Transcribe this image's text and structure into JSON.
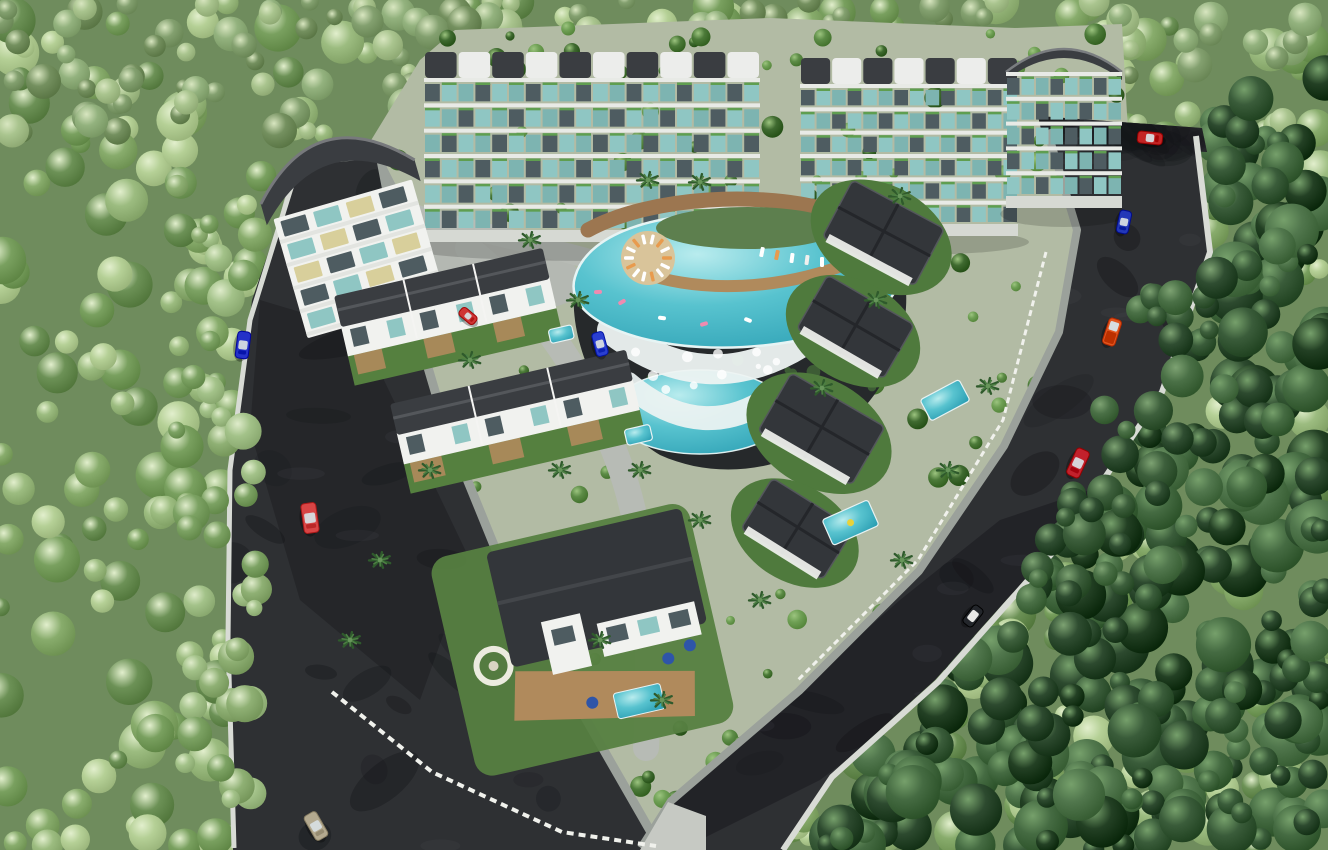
{
  "meta": {
    "width": 1328,
    "height": 850
  },
  "palette": {
    "forest_base": "#6f8c5d",
    "site": "#b2bba4",
    "asphalt": "#2e3033",
    "curb": "#d8dbd5",
    "pavement_parking": "#9ba19b",
    "pavement_plaza": "#b4b8b2",
    "pavement_median": "#c6c9c3",
    "internal_road": "#b7bbb5",
    "pool_deep": "#2da0b4",
    "pool_mid": "#58c3cf",
    "pool_light": "#b9ecee",
    "wood": "#9c7650",
    "wood_light": "#b08a5c",
    "roof_dark": "#3a3d41",
    "roof_villa": "#33363a",
    "facade_white": "#f1f2ef",
    "slab_white": "#e8eae6",
    "glass_teal": "#8fc6c3",
    "glass_dark": "#4e5c61",
    "glass_lit": "#d8cf9b",
    "planter_green": "#5f9e50",
    "garden_green": "#55803f",
    "deck_tan": "#b08a5c",
    "foam_white": "#edf3f2",
    "cliff_dark": "#26292b",
    "fence_white": "#f0f1ec",
    "windshield": "#d7dde0"
  },
  "forest": {
    "zones": [
      {
        "name": "sunlit-forest",
        "layer": "under",
        "rect": [
          0,
          0,
          1328,
          850
        ],
        "count": 520,
        "palette": [
          "#9cbc80",
          "#88ac6c",
          "#79a05f",
          "#b5d096",
          "#6c9156"
        ],
        "highlight": "#e2efcd",
        "rMin": 9,
        "rMax": 24,
        "seed": 7
      },
      {
        "name": "top-band-forest",
        "layer": "under",
        "rect": [
          0,
          0,
          1328,
          140
        ],
        "count": 170,
        "palette": [
          "#83a06f",
          "#93b27e",
          "#74905f",
          "#a9c48e"
        ],
        "highlight": "#d8e6c0",
        "rMin": 8,
        "rMax": 18,
        "seed": 11
      },
      {
        "name": "dark-right-forest",
        "layer": "under",
        "polygon": [
          [
            1205,
            118
          ],
          [
            1328,
            60
          ],
          [
            1328,
            850
          ],
          [
            800,
            850
          ],
          [
            845,
            780
          ],
          [
            950,
            672
          ],
          [
            1072,
            540
          ],
          [
            1172,
            392
          ],
          [
            1218,
            248
          ]
        ],
        "count": 300,
        "palette": [
          "#2d4a2f",
          "#3a5c3a",
          "#234024",
          "#456b42",
          "#51774d"
        ],
        "highlight": "#76a06b",
        "rMin": 10,
        "rMax": 28,
        "seed": 23
      },
      {
        "name": "left-overhang-trees",
        "layer": "over",
        "rect": [
          176,
          170,
          84,
          640
        ],
        "count": 46,
        "palette": [
          "#8fb074",
          "#7ca263",
          "#a3c289"
        ],
        "highlight": "#dfeccb",
        "rMin": 8,
        "rMax": 20,
        "seed": 31
      },
      {
        "name": "right-overhang-trees",
        "layer": "over",
        "polygon": [
          [
            1150,
            260
          ],
          [
            1245,
            260
          ],
          [
            1100,
            650
          ],
          [
            1005,
            650
          ]
        ],
        "count": 38,
        "palette": [
          "#2f4d31",
          "#3d5f3c",
          "#4a7046"
        ],
        "highlight": "#7da272",
        "rMin": 9,
        "rMax": 22,
        "seed": 41
      }
    ]
  },
  "site": {
    "platform": [
      [
        292,
        170
      ],
      [
        370,
        142
      ],
      [
        420,
        60
      ],
      [
        455,
        30
      ],
      [
        770,
        18
      ],
      [
        1015,
        28
      ],
      [
        1122,
        24
      ],
      [
        1128,
        132
      ],
      [
        1092,
        255
      ],
      [
        1048,
        420
      ],
      [
        935,
        595
      ],
      [
        788,
        748
      ],
      [
        665,
        842
      ],
      [
        240,
        845
      ],
      [
        232,
        640
      ],
      [
        236,
        430
      ],
      [
        258,
        300
      ]
    ],
    "garden_scatter": {
      "count": 175,
      "palette": [
        "#4c7a39",
        "#5d8c47",
        "#6fa055",
        "#3f6a30"
      ],
      "highlight": "#9cc47f",
      "rMin": 4,
      "rMax": 11,
      "seed": 53
    }
  },
  "pavements": [
    {
      "name": "upper-left-parking",
      "layer": "under",
      "colorKey": "pavement_parking",
      "polygon": [
        [
          300,
          168
        ],
        [
          378,
          150
        ],
        [
          420,
          232
        ],
        [
          338,
          262
        ]
      ]
    },
    {
      "name": "central-plaza",
      "layer": "under",
      "colorKey": "pavement_plaza",
      "polygon": [
        [
          382,
          200
        ],
        [
          470,
          218
        ],
        [
          560,
          248
        ],
        [
          596,
          292
        ],
        [
          520,
          320
        ],
        [
          430,
          295
        ],
        [
          372,
          240
        ]
      ]
    },
    {
      "name": "bottom-median-island",
      "layer": "over",
      "colorKey": "pavement_median",
      "polygon": [
        [
          640,
          850
        ],
        [
          668,
          802
        ],
        [
          706,
          816
        ],
        [
          706,
          850
        ]
      ]
    }
  ],
  "internal_roads": [
    {
      "name": "internal-road-left",
      "path": "M 468,248 C 540,305 592,385 622,472 C 648,548 652,645 646,748",
      "width": 26
    },
    {
      "name": "internal-road-top",
      "path": "M 395,208 C 455,228 520,240 586,258",
      "width": 20
    }
  ],
  "roads": {
    "segments": [
      {
        "name": "left-perimeter-road",
        "polygon": [
          [
            298,
            166
          ],
          [
            380,
            158
          ],
          [
            408,
            300
          ],
          [
            445,
            425
          ],
          [
            500,
            560
          ],
          [
            575,
            700
          ],
          [
            662,
            850
          ],
          [
            233,
            850
          ],
          [
            228,
            640
          ],
          [
            232,
            470
          ],
          [
            252,
            300
          ]
        ]
      },
      {
        "name": "right-perimeter-road",
        "polygon": [
          [
            1048,
            128
          ],
          [
            1195,
            138
          ],
          [
            1208,
            250
          ],
          [
            1160,
            390
          ],
          [
            1060,
            540
          ],
          [
            935,
            680
          ],
          [
            830,
            775
          ],
          [
            782,
            850
          ],
          [
            640,
            850
          ],
          [
            672,
            800
          ],
          [
            800,
            690
          ],
          [
            920,
            570
          ],
          [
            1005,
            445
          ],
          [
            1060,
            330
          ],
          [
            1078,
            230
          ]
        ]
      },
      {
        "name": "top-access-road",
        "polygon": [
          [
            1038,
            116
          ],
          [
            1202,
            128
          ],
          [
            1207,
            152
          ],
          [
            1044,
            142
          ]
        ]
      }
    ],
    "shadow_patches": {
      "count": 46,
      "seed": 67,
      "opacity": 0.3
    },
    "big_shadows": [
      {
        "name": "right-road-tree-shadow",
        "polygon": [
          [
            1000,
            520
          ],
          [
            1120,
            480
          ],
          [
            940,
            690
          ],
          [
            820,
            780
          ],
          [
            700,
            840
          ],
          [
            640,
            850
          ],
          [
            672,
            800
          ],
          [
            900,
            600
          ]
        ],
        "opacity": 0.38
      },
      {
        "name": "left-road-tree-shadow",
        "polygon": [
          [
            260,
            300
          ],
          [
            360,
            330
          ],
          [
            470,
            560
          ],
          [
            420,
            700
          ],
          [
            300,
            600
          ],
          [
            250,
            430
          ]
        ],
        "opacity": 0.3
      }
    ]
  },
  "walls": [
    {
      "name": "left-road-outer-wall",
      "points": [
        [
          296,
          172
        ],
        [
          250,
          320
        ],
        [
          230,
          470
        ],
        [
          228,
          640
        ],
        [
          234,
          848
        ]
      ],
      "width": 5,
      "colorKey": "curb"
    },
    {
      "name": "right-road-retaining-wall",
      "points": [
        [
          1196,
          136
        ],
        [
          1210,
          252
        ],
        [
          1162,
          392
        ],
        [
          1062,
          542
        ],
        [
          938,
          682
        ],
        [
          832,
          777
        ],
        [
          783,
          850
        ]
      ],
      "width": 6,
      "colorKey": "curb"
    },
    {
      "name": "left-road-inner-curb",
      "points": [
        [
          381,
          160
        ],
        [
          408,
          300
        ],
        [
          445,
          425
        ],
        [
          500,
          560
        ],
        [
          575,
          700
        ],
        [
          660,
          848
        ]
      ],
      "width": 9,
      "colorKey": "pavement_parking"
    },
    {
      "name": "right-road-inner-curb",
      "points": [
        [
          1047,
          130
        ],
        [
          1077,
          230
        ],
        [
          1059,
          332
        ],
        [
          1004,
          446
        ],
        [
          919,
          571
        ],
        [
          799,
          691
        ],
        [
          671,
          801
        ],
        [
          641,
          848
        ]
      ],
      "width": 8,
      "colorKey": "pavement_parking"
    }
  ],
  "fences": [
    {
      "name": "big-villa-picket-fence",
      "points": [
        [
          332,
          692
        ],
        [
          432,
          772
        ],
        [
          562,
          832
        ],
        [
          656,
          846
        ]
      ],
      "dash": "7,5",
      "width": 4
    },
    {
      "name": "hillside-villas-fence",
      "points": [
        [
          1046,
          252
        ],
        [
          1003,
          420
        ],
        [
          918,
          560
        ],
        [
          798,
          680
        ]
      ],
      "dash": "6,4",
      "width": 3
    }
  ],
  "apartment_blocks": [
    {
      "name": "apartment-block-a",
      "x": 424,
      "y": 52,
      "w": 336,
      "h": 190,
      "bays": 10,
      "floors": 6,
      "curvedRoof": false
    },
    {
      "name": "apartment-block-b",
      "x": 800,
      "y": 58,
      "w": 218,
      "h": 178,
      "bays": 7,
      "floors": 6,
      "curvedRoof": false
    },
    {
      "name": "apartment-block-c",
      "x": 1006,
      "y": 42,
      "w": 116,
      "h": 166,
      "bays": 4,
      "floors": 5,
      "curvedRoof": true
    }
  ],
  "arch_building": {
    "name": "arch-roof-building",
    "cx": 352,
    "cy": 232,
    "rot": -16,
    "floors": 5,
    "cols": 4
  },
  "pool_complex": {
    "cliff": "M 578,268 C 560,330 600,420 660,455 C 720,482 790,470 840,430 C 890,392 912,330 905,280 C 860,255 700,245 578,268 Z",
    "lower_pool": {
      "cx": 700,
      "cy": 412,
      "rx": 88,
      "ry": 42
    },
    "cascade2": {
      "path": "M 628,384 Q 704,448 778,392",
      "width": 24
    },
    "cascade1": {
      "path": "M 612,330 Q 706,402 802,342",
      "width": 30
    },
    "main_pool": "M 575,277 C 588,230 668,208 756,216 C 842,224 904,246 899,282 C 888,326 788,352 700,347 C 628,343 563,316 575,277 Z",
    "deck_top": {
      "path": "M 588,230 C 650,196 764,190 834,212 C 892,230 906,252 894,264",
      "width": 15
    },
    "deck_inner": {
      "path": "M 640,272 C 702,294 782,290 852,262",
      "width": 12
    },
    "inner_garden": {
      "cx": 748,
      "cy": 228,
      "rx": 92,
      "ry": 21
    },
    "lounger_island": {
      "cx": 648,
      "cy": 258,
      "r": 27,
      "loungers": 14
    },
    "right_lounger_arc": [
      [
        762,
        252
      ],
      [
        792,
        258
      ],
      [
        822,
        262
      ],
      [
        852,
        262
      ],
      [
        878,
        256
      ],
      [
        896,
        246
      ]
    ],
    "floats": [
      [
        622,
        302
      ],
      [
        662,
        318
      ],
      [
        704,
        324
      ],
      [
        748,
        320
      ],
      [
        598,
        292
      ]
    ]
  },
  "townhouse_rows": [
    {
      "name": "townhouse-row-1",
      "x": 334,
      "y": 296,
      "w": 214,
      "rot": -13,
      "units": 3
    },
    {
      "name": "townhouse-row-2",
      "x": 390,
      "y": 404,
      "w": 242,
      "rot": -13,
      "units": 3
    }
  ],
  "big_villa": {
    "name": "big-villa",
    "x": 428,
    "y": 560,
    "rot": -13,
    "w": 265,
    "h": 225
  },
  "right_villas": [
    {
      "name": "hillside-villa-1",
      "cx": 884,
      "cy": 232,
      "s": 104,
      "rot": 28
    },
    {
      "name": "hillside-villa-2",
      "cx": 856,
      "cy": 326,
      "s": 100,
      "rot": 30
    },
    {
      "name": "hillside-villa-3",
      "cx": 822,
      "cy": 428,
      "s": 108,
      "rot": 30
    },
    {
      "name": "hillside-villa-4",
      "cx": 798,
      "cy": 528,
      "s": 96,
      "rot": 32
    }
  ],
  "villa_pools": [
    {
      "name": "villa-pool-a",
      "x": 920,
      "y": 400,
      "w": 44,
      "h": 24,
      "rot": -28,
      "float": false
    },
    {
      "name": "villa-pool-b",
      "x": 822,
      "y": 520,
      "w": 50,
      "h": 28,
      "rot": -24,
      "float": true
    },
    {
      "name": "villa-pool-c",
      "x": 624,
      "y": 430,
      "w": 26,
      "h": 16,
      "rot": -13,
      "float": false
    },
    {
      "name": "villa-pool-d",
      "x": 548,
      "y": 330,
      "w": 24,
      "h": 14,
      "rot": -13,
      "float": false
    }
  ],
  "palms": [
    [
      578,
      300
    ],
    [
      700,
      182
    ],
    [
      822,
      388
    ],
    [
      876,
      300
    ],
    [
      900,
      196
    ],
    [
      640,
      470
    ],
    [
      700,
      520
    ],
    [
      760,
      600
    ],
    [
      560,
      470
    ],
    [
      470,
      360
    ],
    [
      430,
      470
    ],
    [
      380,
      560
    ],
    [
      350,
      640
    ],
    [
      948,
      470
    ],
    [
      988,
      386
    ],
    [
      902,
      560
    ],
    [
      648,
      180
    ],
    [
      530,
      240
    ],
    [
      600,
      640
    ],
    [
      662,
      700
    ]
  ],
  "vehicles": [
    {
      "name": "car-blue-left-road",
      "x": 243,
      "y": 345,
      "angle": 97,
      "color": "#2431c8",
      "len": 27,
      "wid": 13,
      "kind": "car"
    },
    {
      "name": "car-red-left-road",
      "x": 310,
      "y": 518,
      "angle": 82,
      "color": "#d84545",
      "len": 30,
      "wid": 15,
      "kind": "car"
    },
    {
      "name": "car-tan-bottom-road",
      "x": 316,
      "y": 826,
      "angle": 60,
      "color": "#b3a98f",
      "len": 28,
      "wid": 14,
      "kind": "car"
    },
    {
      "name": "car-blue-plaza",
      "x": 600,
      "y": 344,
      "angle": 75,
      "color": "#2a3fd0",
      "len": 24,
      "wid": 12,
      "kind": "car"
    },
    {
      "name": "car-red-plaza",
      "x": 468,
      "y": 316,
      "angle": 40,
      "color": "#cf3434",
      "len": 19,
      "wid": 10,
      "kind": "car"
    },
    {
      "name": "car-red-top-road",
      "x": 1150,
      "y": 138,
      "angle": 6,
      "color": "#c32525",
      "len": 25,
      "wid": 12,
      "kind": "car"
    },
    {
      "name": "car-blue-right-road",
      "x": 1124,
      "y": 222,
      "angle": 102,
      "color": "#2338b8",
      "len": 23,
      "wid": 12,
      "kind": "car"
    },
    {
      "name": "truck-orange-right-road",
      "x": 1112,
      "y": 332,
      "angle": 108,
      "color": "#e2561e",
      "len": 27,
      "wid": 13,
      "kind": "truck"
    },
    {
      "name": "car-red-right-road",
      "x": 1078,
      "y": 463,
      "angle": 115,
      "color": "#c2212c",
      "len": 29,
      "wid": 14,
      "kind": "car"
    },
    {
      "name": "buggy-dark-right-road",
      "x": 973,
      "y": 616,
      "angle": 128,
      "color": "#23262b",
      "len": 22,
      "wid": 12,
      "kind": "buggy"
    }
  ]
}
